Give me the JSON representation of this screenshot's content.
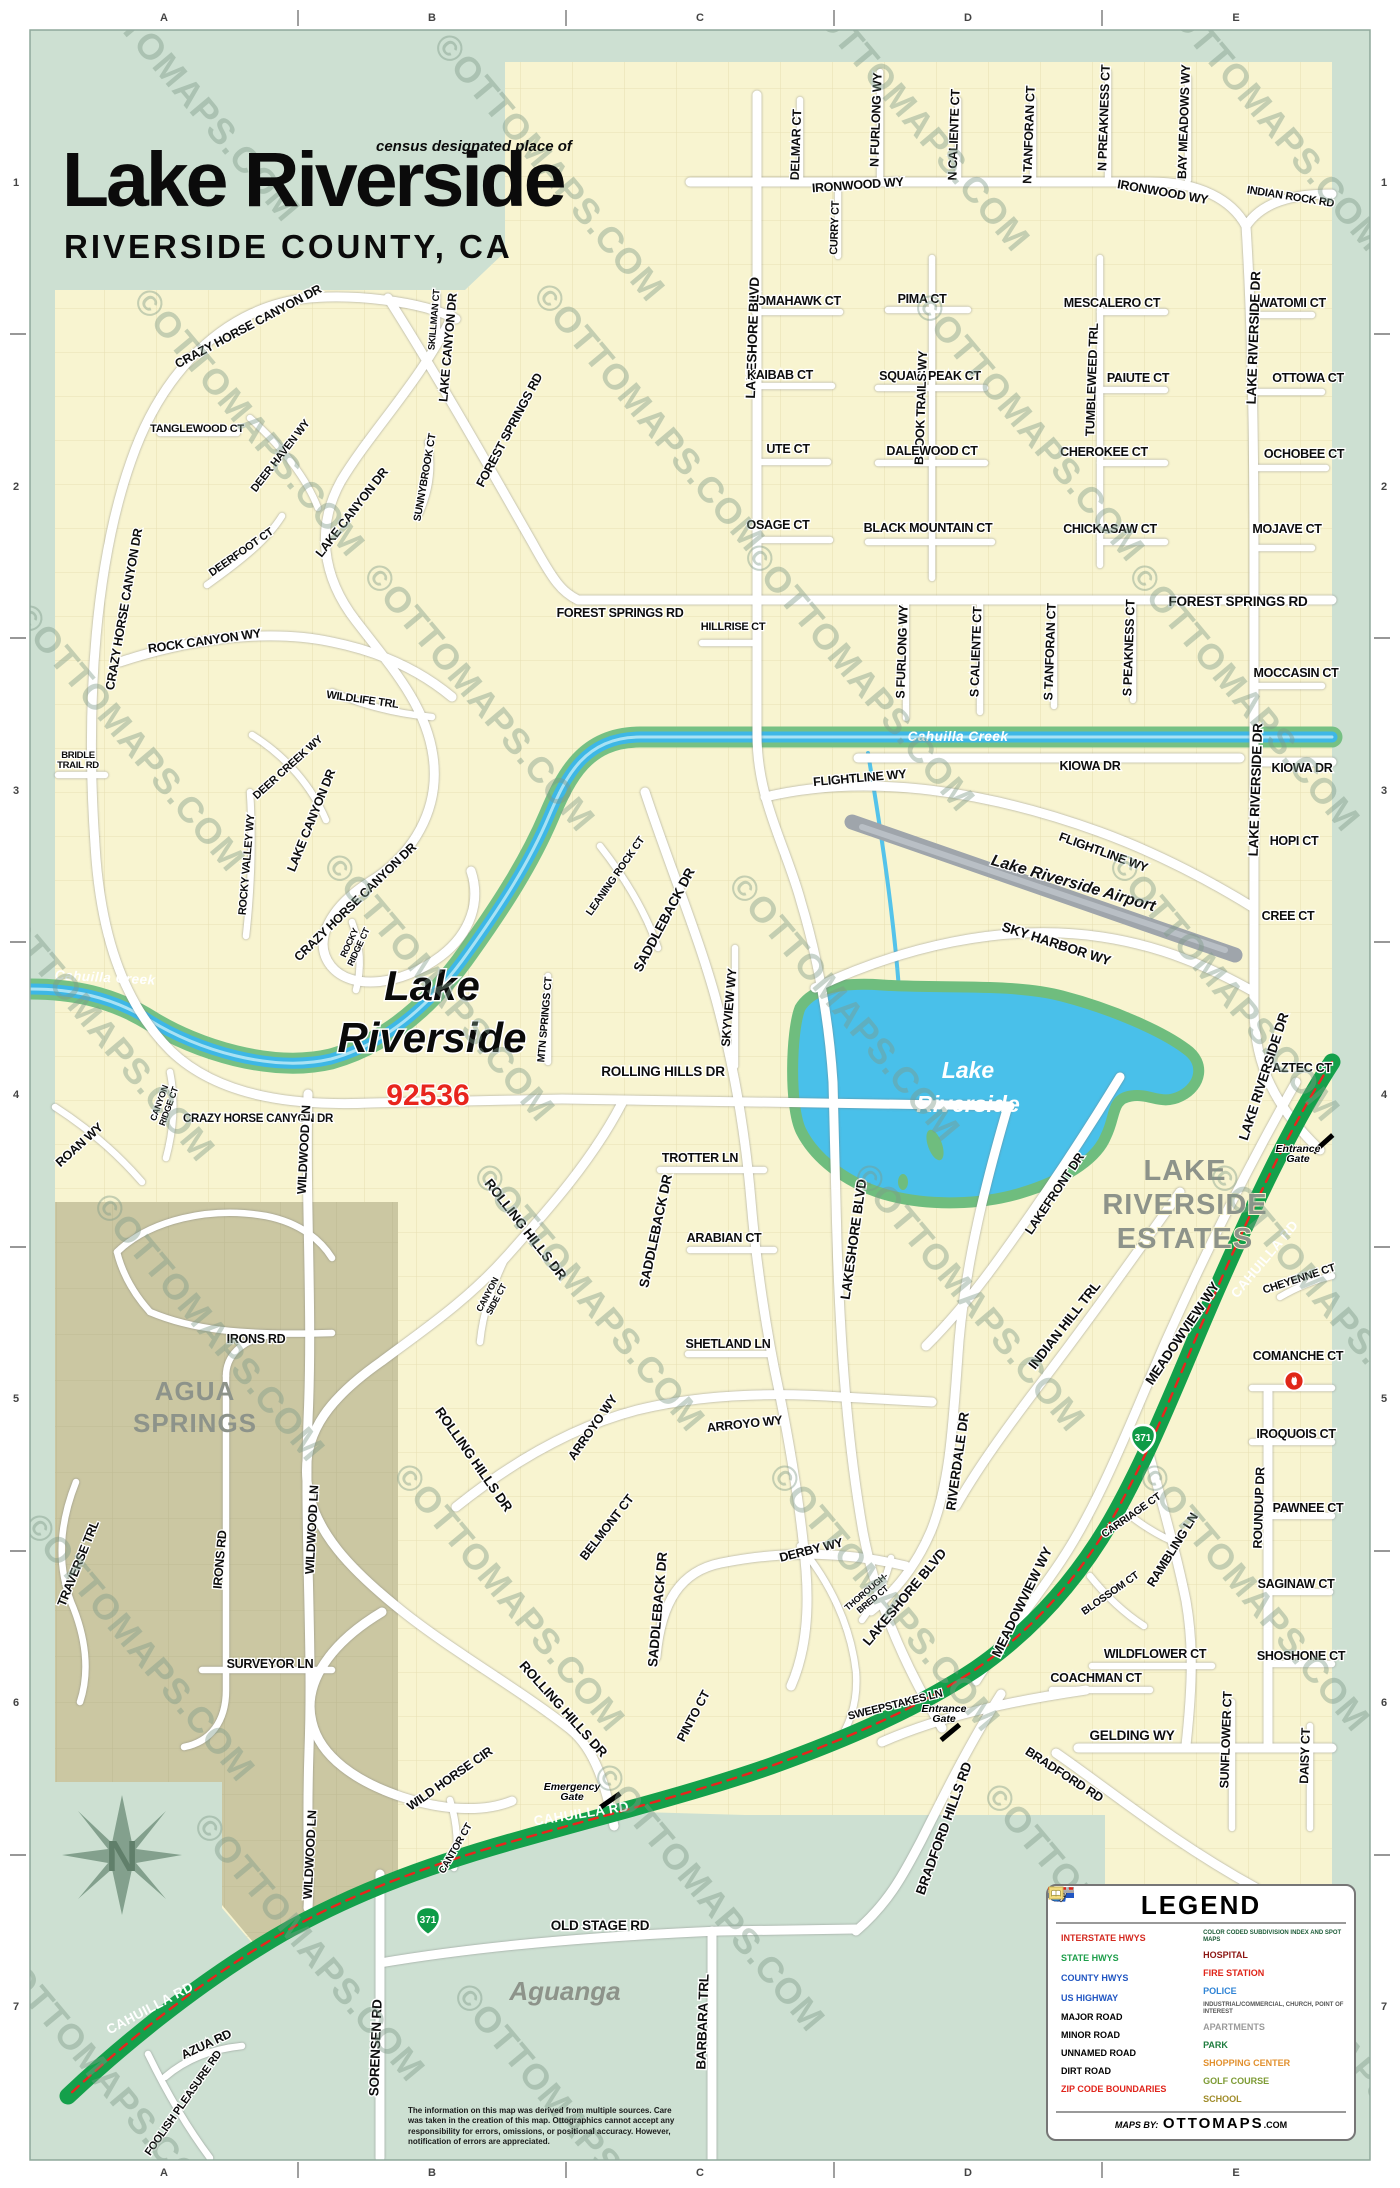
{
  "header": {
    "kicker": "census designated place of",
    "title": "Lake Riverside",
    "subtitle": "RIVERSIDE COUNTY, CA"
  },
  "colors": {
    "background_mint": "#cde0d2",
    "land_yellow": "#f8f4d0",
    "land_olive": "#cbc7a2",
    "water_blue": "#49c0ea",
    "creek_green": "#76c083",
    "highway_green": "#14a04b",
    "zip_red": "#e8251d",
    "place_gray": "#8d938a"
  },
  "map": {
    "grid": {
      "cols": [
        "A",
        "B",
        "C",
        "D",
        "E"
      ],
      "rows": [
        "1",
        "2",
        "3",
        "4",
        "5",
        "6",
        "7"
      ]
    },
    "highways": {
      "state_route": "371"
    },
    "watermark": {
      "text": "©OTTOMAPS.COM",
      "positions": [
        [
          175,
          95
        ],
        [
          540,
          175
        ],
        [
          905,
          125
        ],
        [
          1260,
          125
        ],
        [
          240,
          430
        ],
        [
          640,
          425
        ],
        [
          1020,
          435
        ],
        [
          120,
          745
        ],
        [
          470,
          705
        ],
        [
          850,
          685
        ],
        [
          1235,
          705
        ],
        [
          90,
          1035
        ],
        [
          430,
          995
        ],
        [
          835,
          1015
        ],
        [
          1215,
          995
        ],
        [
          200,
          1335
        ],
        [
          580,
          1305
        ],
        [
          960,
          1305
        ],
        [
          1315,
          1305
        ],
        [
          130,
          1655
        ],
        [
          500,
          1605
        ],
        [
          875,
          1605
        ],
        [
          1245,
          1605
        ],
        [
          300,
          1955
        ],
        [
          700,
          1905
        ],
        [
          1090,
          1925
        ],
        [
          95,
          2085
        ],
        [
          560,
          2125
        ],
        [
          1335,
          2055
        ]
      ]
    },
    "labels": [
      {
        "t": "DELMAR CT",
        "x": 800,
        "y": 145,
        "r": -88
      },
      {
        "t": "N FURLONG WY",
        "x": 880,
        "y": 120,
        "r": -88
      },
      {
        "t": "N CALIENTE CT",
        "x": 958,
        "y": 135,
        "r": -88
      },
      {
        "t": "N TANFORAN CT",
        "x": 1033,
        "y": 135,
        "r": -88
      },
      {
        "t": "N PREAKNESS CT",
        "x": 1108,
        "y": 118,
        "r": -88
      },
      {
        "t": "BAY MEADOWS WY",
        "x": 1188,
        "y": 122,
        "r": -88
      },
      {
        "t": "IRONWOOD WY",
        "x": 858,
        "y": 189,
        "r": -4
      },
      {
        "t": "IRONWOOD WY",
        "x": 1162,
        "y": 196,
        "r": 10
      },
      {
        "t": "INDIAN ROCK RD",
        "x": 1290,
        "y": 200,
        "r": 9,
        "s": 11
      },
      {
        "t": "CURRY CT",
        "x": 838,
        "y": 228,
        "r": -88,
        "s": 11
      },
      {
        "t": "TOMAHAWK CT",
        "x": 795,
        "y": 305
      },
      {
        "t": "PIMA CT",
        "x": 922,
        "y": 303
      },
      {
        "t": "MESCALERO CT",
        "x": 1112,
        "y": 307
      },
      {
        "t": "WATOMI CT",
        "x": 1292,
        "y": 307
      },
      {
        "t": "LAKESHORE BLVD",
        "x": 757,
        "y": 338,
        "r": -88,
        "k": "big"
      },
      {
        "t": "KAIBAB CT",
        "x": 780,
        "y": 379
      },
      {
        "t": "SQUAW PEAK CT",
        "x": 930,
        "y": 380
      },
      {
        "t": "PAIUTE CT",
        "x": 1138,
        "y": 382
      },
      {
        "t": "OTTOWA CT",
        "x": 1308,
        "y": 382
      },
      {
        "t": "BROOK TRAILS WY",
        "x": 925,
        "y": 408,
        "r": -88
      },
      {
        "t": "TUMBLEWEED TRL",
        "x": 1096,
        "y": 380,
        "r": -88
      },
      {
        "t": "UTE CT",
        "x": 788,
        "y": 453
      },
      {
        "t": "DALEWOOD CT",
        "x": 932,
        "y": 455
      },
      {
        "t": "CHEROKEE CT",
        "x": 1104,
        "y": 456
      },
      {
        "t": "OCHOBEE CT",
        "x": 1304,
        "y": 458
      },
      {
        "t": "OSAGE CT",
        "x": 778,
        "y": 529
      },
      {
        "t": "BLACK MOUNTAIN CT",
        "x": 928,
        "y": 532
      },
      {
        "t": "CHICKASAW CT",
        "x": 1110,
        "y": 533
      },
      {
        "t": "MOJAVE CT",
        "x": 1287,
        "y": 533
      },
      {
        "t": "FOREST SPRINGS RD",
        "x": 513,
        "y": 432,
        "r": -62
      },
      {
        "t": "FOREST SPRINGS RD",
        "x": 620,
        "y": 617
      },
      {
        "t": "FOREST SPRINGS RD",
        "x": 1238,
        "y": 606,
        "k": "big"
      },
      {
        "t": "HILLRISE CT",
        "x": 733,
        "y": 630,
        "s": 11
      },
      {
        "t": "S FURLONG WY",
        "x": 906,
        "y": 652,
        "r": -88
      },
      {
        "t": "S CALIENTE CT",
        "x": 980,
        "y": 652,
        "r": -88
      },
      {
        "t": "S TANFORAN CT",
        "x": 1054,
        "y": 652,
        "r": -88
      },
      {
        "t": "S PEAKNESS CT",
        "x": 1133,
        "y": 648,
        "r": -88
      },
      {
        "t": "MOCCASIN CT",
        "x": 1296,
        "y": 677
      },
      {
        "t": "LAKE RIVERSIDE DR",
        "x": 1258,
        "y": 338,
        "r": -88,
        "k": "big"
      },
      {
        "t": "LAKE RIVERSIDE DR",
        "x": 1260,
        "y": 790,
        "r": -88,
        "k": "big"
      },
      {
        "t": "LAKE RIVERSIDE DR",
        "x": 1268,
        "y": 1078,
        "r": -72,
        "k": "big"
      },
      {
        "t": "CRAZY HORSE CANYON DR",
        "x": 250,
        "y": 330,
        "r": -28
      },
      {
        "t": "CRAZY HORSE CANYON DR",
        "x": 128,
        "y": 610,
        "r": -80
      },
      {
        "t": "CRAZY HORSE CANYON DR",
        "x": 358,
        "y": 905,
        "r": -44
      },
      {
        "t": "CRAZY HORSE CANYON DR",
        "x": 258,
        "y": 1122,
        "s": 11.5
      },
      {
        "t": "TANGLEWOOD CT",
        "x": 197,
        "y": 432,
        "s": 11
      },
      {
        "t": "DEER HAVEN WY",
        "x": 283,
        "y": 458,
        "r": -52,
        "s": 11
      },
      {
        "t": "DEERFOOT CT",
        "x": 243,
        "y": 555,
        "r": -35,
        "s": 11
      },
      {
        "t": "ROCK CANYON WY",
        "x": 205,
        "y": 645,
        "r": -8
      },
      {
        "t": "WILDLIFE TRL",
        "x": 362,
        "y": 703,
        "r": 8,
        "s": 11
      },
      {
        "t": "SUNNYBROOK CT",
        "x": 428,
        "y": 478,
        "r": -80,
        "s": 10.5
      },
      {
        "t": "SKILLMAN CT",
        "x": 437,
        "y": 320,
        "r": -85,
        "s": 9.5
      },
      {
        "t": "LAKE CANYON DR",
        "x": 452,
        "y": 348,
        "r": -85
      },
      {
        "t": "LAKE CANYON DR",
        "x": 355,
        "y": 515,
        "r": -52
      },
      {
        "t": "LAKE CANYON DR",
        "x": 315,
        "y": 822,
        "r": -68
      },
      {
        "t": "BRIDLE\nTRAIL RD",
        "x": 78,
        "y": 758,
        "s": 9.5
      },
      {
        "t": "DEER CREEK WY",
        "x": 290,
        "y": 770,
        "r": -42,
        "s": 11
      },
      {
        "t": "ROCKY VALLEY WY",
        "x": 250,
        "y": 865,
        "r": -85,
        "s": 11
      },
      {
        "t": "ROCKY\nRIDGE CT",
        "x": 352,
        "y": 944,
        "r": -65,
        "s": 9
      },
      {
        "t": "Cahuilla Creek",
        "x": 105,
        "y": 982,
        "r": 3,
        "k": "creek"
      },
      {
        "t": "Cahuilla Creek",
        "x": 958,
        "y": 741,
        "k": "creek"
      },
      {
        "t": "Lake",
        "x": 432,
        "y": 1000,
        "k": "maplbl"
      },
      {
        "t": "Riverside",
        "x": 432,
        "y": 1052,
        "k": "maplbl"
      },
      {
        "t": "92536",
        "x": 428,
        "y": 1105,
        "k": "zip"
      },
      {
        "t": "LEANING ROCK CT",
        "x": 618,
        "y": 878,
        "r": -55,
        "s": 10.5
      },
      {
        "t": "SADDLEBACK DR",
        "x": 668,
        "y": 922,
        "r": -62,
        "k": "big"
      },
      {
        "t": "MTN SPRINGS CT",
        "x": 548,
        "y": 1020,
        "r": -85,
        "s": 10.5
      },
      {
        "t": "SKYVIEW WY",
        "x": 733,
        "y": 1008,
        "r": -85
      },
      {
        "t": "ROLLING HILLS DR",
        "x": 663,
        "y": 1076,
        "k": "big"
      },
      {
        "t": "TROTTER LN",
        "x": 700,
        "y": 1162
      },
      {
        "t": "ARABIAN CT",
        "x": 724,
        "y": 1242
      },
      {
        "t": "SADDLEBACK DR",
        "x": 660,
        "y": 1232,
        "r": -78,
        "k": "big"
      },
      {
        "t": "ROLLING HILLS DR",
        "x": 522,
        "y": 1232,
        "r": 52,
        "k": "big"
      },
      {
        "t": "CANYON\nSIDE CT",
        "x": 490,
        "y": 1296,
        "r": -62,
        "s": 9
      },
      {
        "t": "CANYON\nRIDGE CT",
        "x": 162,
        "y": 1104,
        "r": -70,
        "s": 9
      },
      {
        "t": "SHETLAND LN",
        "x": 728,
        "y": 1348
      },
      {
        "t": "WILDWOOD LN",
        "x": 308,
        "y": 1150,
        "r": -87
      },
      {
        "t": "ROAN WY",
        "x": 82,
        "y": 1148,
        "r": -42
      },
      {
        "t": "ARROYO WY",
        "x": 596,
        "y": 1430,
        "r": -55
      },
      {
        "t": "ARROYO WY",
        "x": 745,
        "y": 1428,
        "r": -6
      },
      {
        "t": "ROLLING HILLS DR",
        "x": 470,
        "y": 1462,
        "r": 55,
        "k": "big"
      },
      {
        "t": "ROLLING HILLS DR",
        "x": 560,
        "y": 1712,
        "r": 48,
        "k": "big"
      },
      {
        "t": "BELMONT CT",
        "x": 610,
        "y": 1530,
        "r": -52
      },
      {
        "t": "SADDLEBACK DR",
        "x": 662,
        "y": 1610,
        "r": -85,
        "k": "big"
      },
      {
        "t": "PINTO CT",
        "x": 697,
        "y": 1718,
        "r": -62
      },
      {
        "t": "DERBY WY",
        "x": 812,
        "y": 1554,
        "r": -14
      },
      {
        "t": "THOROUGH-\nBRED CT",
        "x": 868,
        "y": 1594,
        "r": -40,
        "s": 9
      },
      {
        "t": "LAKESHORE BLVD",
        "x": 858,
        "y": 1240,
        "r": -82,
        "k": "big"
      },
      {
        "t": "LAKESHORE BLVD",
        "x": 908,
        "y": 1600,
        "r": -50,
        "k": "big"
      },
      {
        "t": "SWEEPSTAKES LN",
        "x": 896,
        "y": 1708,
        "r": -14,
        "s": 11
      },
      {
        "t": "Entrance\nGate",
        "x": 944,
        "y": 1712,
        "k": "gate"
      },
      {
        "t": "Emergency\nGate",
        "x": 572,
        "y": 1790,
        "k": "gate"
      },
      {
        "t": "Entrance\nGate",
        "x": 1298,
        "y": 1152,
        "k": "gate"
      },
      {
        "t": "RIVERDALE DR",
        "x": 962,
        "y": 1462,
        "r": -82,
        "k": "big"
      },
      {
        "t": "INDIAN HILL TRL",
        "x": 1068,
        "y": 1328,
        "r": -52,
        "k": "big"
      },
      {
        "t": "LAKEFRONT DR",
        "x": 1058,
        "y": 1196,
        "r": -56
      },
      {
        "t": "MEADOWVIEW WY",
        "x": 1186,
        "y": 1336,
        "r": -56,
        "k": "big"
      },
      {
        "t": "MEADOWVIEW WY",
        "x": 1026,
        "y": 1604,
        "r": -64,
        "k": "big"
      },
      {
        "t": "CAHUILLA RD",
        "x": 1268,
        "y": 1262,
        "r": -50,
        "k": "wst"
      },
      {
        "t": "CAHUILLA RD",
        "x": 582,
        "y": 1818,
        "r": -9,
        "k": "wst"
      },
      {
        "t": "CAHUILLA RD",
        "x": 152,
        "y": 2012,
        "r": -28,
        "k": "wst"
      },
      {
        "t": "KIOWA DR",
        "x": 1090,
        "y": 770
      },
      {
        "t": "KIOWA DR",
        "x": 1302,
        "y": 772
      },
      {
        "t": "FLIGHTLINE WY",
        "x": 860,
        "y": 782,
        "r": -5
      },
      {
        "t": "FLIGHTLINE WY",
        "x": 1102,
        "y": 856,
        "r": 20
      },
      {
        "t": "Lake Riverside Airport",
        "x": 1072,
        "y": 888,
        "r": 16,
        "k": "air"
      },
      {
        "t": "SKY HARBOR WY",
        "x": 1055,
        "y": 948,
        "r": 18,
        "k": "big"
      },
      {
        "t": "HOPI CT",
        "x": 1294,
        "y": 845
      },
      {
        "t": "CREE CT",
        "x": 1288,
        "y": 920
      },
      {
        "t": "AZTEC CT",
        "x": 1302,
        "y": 1072
      },
      {
        "t": "Lake",
        "x": 968,
        "y": 1078,
        "k": "lakelbl"
      },
      {
        "t": "Riverside",
        "x": 968,
        "y": 1112,
        "k": "lakelbl"
      },
      {
        "t": "LAKE",
        "x": 1185,
        "y": 1180,
        "k": "place30"
      },
      {
        "t": "RIVERSIDE",
        "x": 1185,
        "y": 1214,
        "k": "place30"
      },
      {
        "t": "ESTATES",
        "x": 1185,
        "y": 1248,
        "k": "place30"
      },
      {
        "t": "CHEYENNE CT",
        "x": 1300,
        "y": 1282,
        "r": -18,
        "s": 11
      },
      {
        "t": "COMANCHE CT",
        "x": 1298,
        "y": 1360
      },
      {
        "t": "IROQUOIS CT",
        "x": 1296,
        "y": 1438
      },
      {
        "t": "ROUNDUP DR",
        "x": 1263,
        "y": 1508,
        "r": -88
      },
      {
        "t": "PAWNEE CT",
        "x": 1308,
        "y": 1512
      },
      {
        "t": "RAMBLING LN",
        "x": 1176,
        "y": 1552,
        "r": -58
      },
      {
        "t": "CARRIAGE CT",
        "x": 1133,
        "y": 1518,
        "r": -35,
        "s": 10.5
      },
      {
        "t": "SAGINAW CT",
        "x": 1296,
        "y": 1588
      },
      {
        "t": "BLOSSOM CT",
        "x": 1112,
        "y": 1596,
        "r": -35,
        "s": 10.5
      },
      {
        "t": "WILDFLOWER CT",
        "x": 1155,
        "y": 1658
      },
      {
        "t": "SHOSHONE CT",
        "x": 1301,
        "y": 1660
      },
      {
        "t": "COACHMAN CT",
        "x": 1096,
        "y": 1682
      },
      {
        "t": "SUNFLOWER CT",
        "x": 1230,
        "y": 1740,
        "r": -88
      },
      {
        "t": "DAISY CT",
        "x": 1309,
        "y": 1756,
        "r": -88
      },
      {
        "t": "GELDING WY",
        "x": 1132,
        "y": 1740,
        "k": "big"
      },
      {
        "t": "BRADFORD RD",
        "x": 1062,
        "y": 1778,
        "r": 33
      },
      {
        "t": "BRADFORD HILLS RD",
        "x": 948,
        "y": 1830,
        "r": -70,
        "k": "big"
      },
      {
        "t": "WILD HORSE CIR",
        "x": 452,
        "y": 1782,
        "r": -35
      },
      {
        "t": "CANTOR CT",
        "x": 458,
        "y": 1850,
        "r": -60,
        "s": 10
      },
      {
        "t": "OLD STAGE RD",
        "x": 600,
        "y": 1930,
        "k": "big"
      },
      {
        "t": "BARBARA TRL",
        "x": 707,
        "y": 2022,
        "r": -88,
        "k": "big"
      },
      {
        "t": "SORENSEN RD",
        "x": 380,
        "y": 2048,
        "r": -88,
        "k": "big"
      },
      {
        "t": "AZUA RD",
        "x": 208,
        "y": 2048,
        "r": -25
      },
      {
        "t": "FOOLISH PLEASURE RD",
        "x": 186,
        "y": 2105,
        "r": -55,
        "s": 11
      },
      {
        "t": "Aguanga",
        "x": 565,
        "y": 2000,
        "k": "cityit"
      },
      {
        "t": "AGUA",
        "x": 195,
        "y": 1400,
        "k": "place26"
      },
      {
        "t": "SPRINGS",
        "x": 195,
        "y": 1432,
        "k": "place26"
      },
      {
        "t": "IRONS RD",
        "x": 256,
        "y": 1343
      },
      {
        "t": "IRONS RD",
        "x": 224,
        "y": 1560,
        "r": -85
      },
      {
        "t": "TRAVERSE TRL",
        "x": 82,
        "y": 1565,
        "r": -68
      },
      {
        "t": "SURVEYOR LN",
        "x": 270,
        "y": 1668
      },
      {
        "t": "WILDWOOD LN",
        "x": 316,
        "y": 1530,
        "r": -87
      },
      {
        "t": "WILDWOOD LN",
        "x": 314,
        "y": 1855,
        "r": -87
      }
    ]
  },
  "legend": {
    "title": "LEGEND",
    "interstate": {
      "shield": "5",
      "label": "INTERSTATE HWYS"
    },
    "state": {
      "shield": "56",
      "label": "STATE HWYS"
    },
    "county": {
      "shield": "57",
      "label": "COUNTY HWYS"
    },
    "us": {
      "shield": "131",
      "label": "US HIGHWAY"
    },
    "major": "MAJOR ROAD",
    "minor": "MINOR ROAD",
    "unnamed": "UNNAMED ROAD",
    "dirt": "DIRT ROAD",
    "zip": "ZIP CODE BOUNDARIES",
    "subdivision": {
      "badge": "1",
      "label": "COLOR CODED SUBDIVISION INDEX AND SPOT MAPS"
    },
    "hospital": "HOSPITAL",
    "fire": "FIRE STATION",
    "police": "POLICE",
    "industrial": "INDUSTRIAL/COMMERCIAL, CHURCH, POINT OF INTEREST",
    "apartments": "APARTMENTS",
    "park": "PARK",
    "shopping": "SHOPPING CENTER",
    "golf": "GOLF COURSE",
    "school": "SCHOOL",
    "credit_prefix": "MAPS BY:",
    "credit_brand": "OTTOMAPS",
    "credit_suffix": ".COM"
  },
  "disclaimer": "The information on this map was derived from multiple sources. Care was taken in the creation of this map. Ottographics cannot accept any responsibility for errors, omissions, or positional accuracy. However, notification of errors are appreciated."
}
